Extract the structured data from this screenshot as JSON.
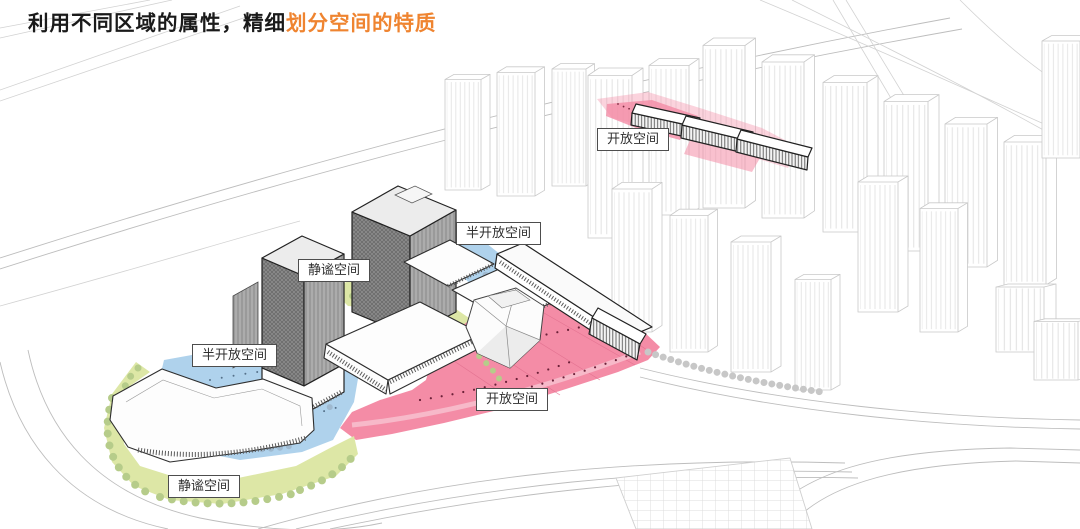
{
  "title": {
    "black": "利用不同区域的属性，精细",
    "orange": "划分空间的特质"
  },
  "labels": [
    {
      "id": "open-space-top",
      "text": "开放空间"
    },
    {
      "id": "semi-open-space-upper",
      "text": "半开放空间"
    },
    {
      "id": "quiet-space-center",
      "text": "静谧空间"
    },
    {
      "id": "semi-open-space-left",
      "text": "半开放空间"
    },
    {
      "id": "open-space-bottom",
      "text": "开放空间"
    },
    {
      "id": "quiet-space-bottom",
      "text": "静谧空间"
    }
  ],
  "zones": [
    {
      "name": "开放空间",
      "meaning": "open space",
      "color": "#F48CA6"
    },
    {
      "name": "半开放空间",
      "meaning": "semi-open space",
      "color": "#AFD2EC"
    },
    {
      "name": "静谧空间",
      "meaning": "quiet space",
      "color": "#DDE7A6"
    }
  ],
  "colors": {
    "accent": "#EF8430",
    "title_text": "#1A1A1A",
    "open_pink": "#F48CA6",
    "semi_open_blue": "#AFD2EC",
    "quiet_green": "#DDE7A6",
    "wireframe": "#C9C9C9",
    "building_dark": "#2E2E2E"
  }
}
